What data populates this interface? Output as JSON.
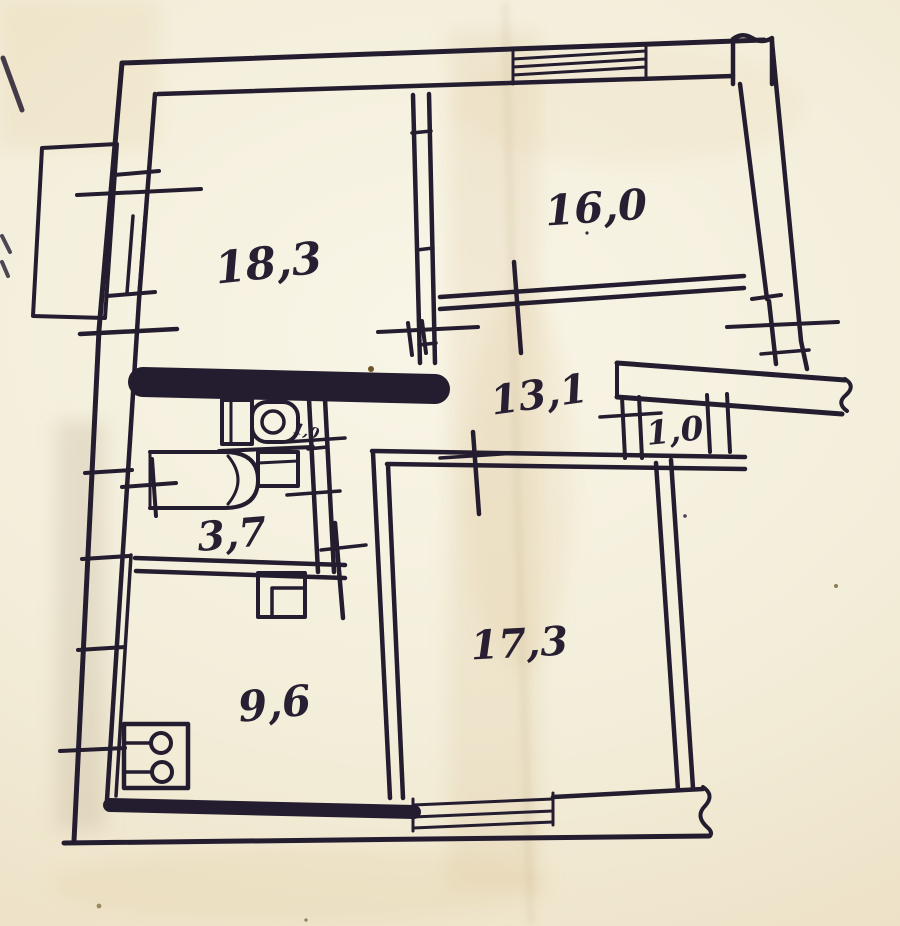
{
  "plan": {
    "type": "hand-drawn apartment floor plan (scanned photo)",
    "ink_color": "#241c2f",
    "paper_color": "#f3eeda",
    "units": "square meters, comma decimal separator",
    "rooms": [
      {
        "name": "living-room-large",
        "area": "18,3"
      },
      {
        "name": "bedroom",
        "area": "16,0"
      },
      {
        "name": "hallway",
        "area": "13,1"
      },
      {
        "name": "closet",
        "area": "1,0"
      },
      {
        "name": "bathroom",
        "area": "3,7"
      },
      {
        "name": "wc",
        "area": "1,0"
      },
      {
        "name": "kitchen",
        "area": "9,6"
      },
      {
        "name": "living-room-small",
        "area": "17,3"
      }
    ],
    "fixtures": [
      "toilet",
      "bathtub",
      "sink",
      "stove",
      "vent-shaft"
    ],
    "features": [
      "balcony",
      "top-window",
      "left-window",
      "bottom-window",
      "door-swing-ticks",
      "wall-break-squiggles",
      "paper-fold-crease"
    ]
  }
}
